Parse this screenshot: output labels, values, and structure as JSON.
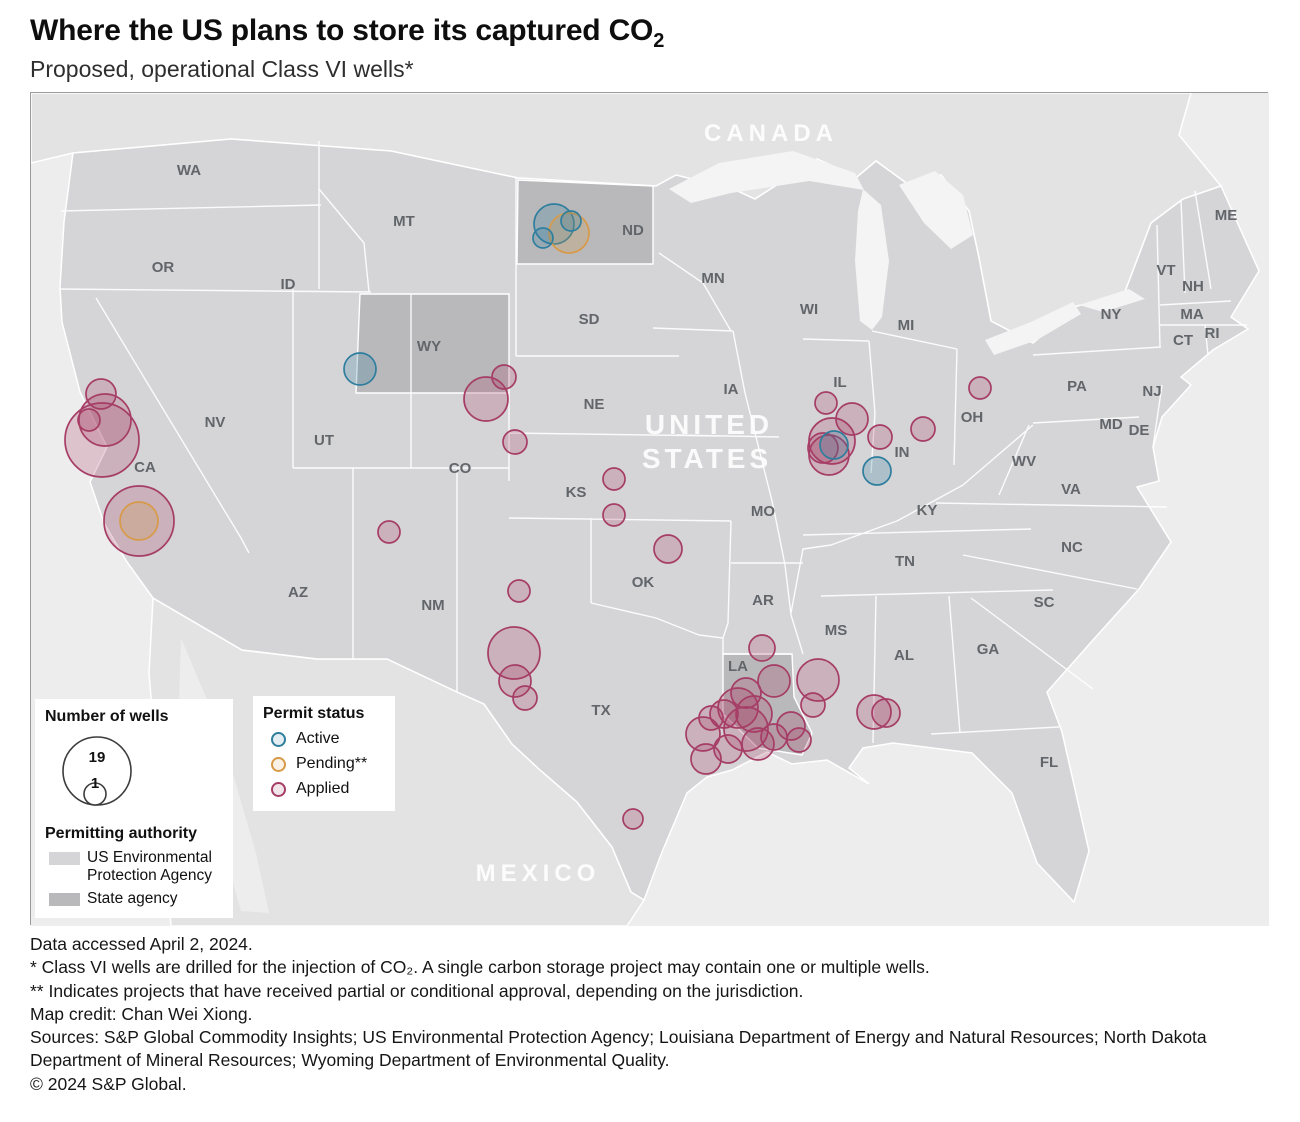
{
  "header": {
    "title_main": "Where the US plans to store its captured CO",
    "title_sub": "2",
    "subtitle": "Proposed, operational Class VI wells*"
  },
  "map": {
    "region_labels": [
      {
        "text": "CANADA",
        "x": 740,
        "y": 48,
        "size": 24,
        "spacing": 5
      },
      {
        "text": "UNITED",
        "x": 678,
        "y": 341,
        "size": 28,
        "spacing": 4
      },
      {
        "text": "STATES",
        "x": 676,
        "y": 375,
        "size": 28,
        "spacing": 4
      },
      {
        "text": "MEXICO",
        "x": 507,
        "y": 788,
        "size": 24,
        "spacing": 5
      }
    ],
    "state_labels": [
      {
        "t": "WA",
        "x": 158,
        "y": 76
      },
      {
        "t": "OR",
        "x": 132,
        "y": 173
      },
      {
        "t": "CA",
        "x": 114,
        "y": 373
      },
      {
        "t": "NV",
        "x": 184,
        "y": 328
      },
      {
        "t": "ID",
        "x": 257,
        "y": 190
      },
      {
        "t": "MT",
        "x": 373,
        "y": 127
      },
      {
        "t": "WY",
        "x": 398,
        "y": 252
      },
      {
        "t": "UT",
        "x": 293,
        "y": 346
      },
      {
        "t": "AZ",
        "x": 267,
        "y": 498
      },
      {
        "t": "NM",
        "x": 402,
        "y": 511
      },
      {
        "t": "CO",
        "x": 429,
        "y": 374
      },
      {
        "t": "ND",
        "x": 602,
        "y": 136
      },
      {
        "t": "SD",
        "x": 558,
        "y": 225
      },
      {
        "t": "NE",
        "x": 563,
        "y": 310
      },
      {
        "t": "KS",
        "x": 545,
        "y": 398
      },
      {
        "t": "OK",
        "x": 612,
        "y": 488
      },
      {
        "t": "TX",
        "x": 570,
        "y": 616
      },
      {
        "t": "MN",
        "x": 682,
        "y": 184
      },
      {
        "t": "IA",
        "x": 700,
        "y": 295
      },
      {
        "t": "MO",
        "x": 732,
        "y": 417
      },
      {
        "t": "AR",
        "x": 732,
        "y": 506
      },
      {
        "t": "LA",
        "x": 707,
        "y": 572
      },
      {
        "t": "WI",
        "x": 778,
        "y": 215
      },
      {
        "t": "IL",
        "x": 809,
        "y": 288
      },
      {
        "t": "MI",
        "x": 875,
        "y": 231
      },
      {
        "t": "IN",
        "x": 871,
        "y": 358
      },
      {
        "t": "OH",
        "x": 941,
        "y": 323
      },
      {
        "t": "KY",
        "x": 896,
        "y": 416
      },
      {
        "t": "TN",
        "x": 874,
        "y": 467
      },
      {
        "t": "MS",
        "x": 805,
        "y": 536
      },
      {
        "t": "AL",
        "x": 873,
        "y": 561
      },
      {
        "t": "GA",
        "x": 957,
        "y": 555
      },
      {
        "t": "SC",
        "x": 1013,
        "y": 508
      },
      {
        "t": "NC",
        "x": 1041,
        "y": 453
      },
      {
        "t": "VA",
        "x": 1040,
        "y": 395
      },
      {
        "t": "WV",
        "x": 993,
        "y": 367
      },
      {
        "t": "FL",
        "x": 1018,
        "y": 668
      },
      {
        "t": "PA",
        "x": 1046,
        "y": 292
      },
      {
        "t": "NY",
        "x": 1080,
        "y": 220
      },
      {
        "t": "NJ",
        "x": 1121,
        "y": 297
      },
      {
        "t": "MD",
        "x": 1080,
        "y": 330
      },
      {
        "t": "DE",
        "x": 1108,
        "y": 336
      },
      {
        "t": "CT",
        "x": 1152,
        "y": 246
      },
      {
        "t": "RI",
        "x": 1181,
        "y": 239
      },
      {
        "t": "MA",
        "x": 1161,
        "y": 220
      },
      {
        "t": "VT",
        "x": 1135,
        "y": 176
      },
      {
        "t": "NH",
        "x": 1162,
        "y": 192
      },
      {
        "t": "ME",
        "x": 1195,
        "y": 121
      }
    ],
    "status_colors": {
      "active": "#2f7e9e",
      "pending": "#d79a48",
      "applied": "#a63d66"
    },
    "authority_colors": {
      "epa": "#d5d5d7",
      "state": "#b9b9bb"
    },
    "bubbles": [
      {
        "x": 523,
        "y": 131,
        "r": 20,
        "s": "active"
      },
      {
        "x": 538,
        "y": 140,
        "r": 20,
        "s": "pending"
      },
      {
        "x": 540,
        "y": 128,
        "r": 10,
        "s": "active"
      },
      {
        "x": 512,
        "y": 145,
        "r": 10,
        "s": "active"
      },
      {
        "x": 329,
        "y": 276,
        "r": 16,
        "s": "active"
      },
      {
        "x": 455,
        "y": 306,
        "r": 22,
        "s": "applied"
      },
      {
        "x": 473,
        "y": 284,
        "r": 12,
        "s": "applied"
      },
      {
        "x": 70,
        "y": 301,
        "r": 15,
        "s": "applied"
      },
      {
        "x": 74,
        "y": 327,
        "r": 26,
        "s": "applied"
      },
      {
        "x": 58,
        "y": 327,
        "r": 11,
        "s": "applied"
      },
      {
        "x": 71,
        "y": 347,
        "r": 37,
        "s": "applied"
      },
      {
        "x": 108,
        "y": 428,
        "r": 35,
        "s": "applied"
      },
      {
        "x": 108,
        "y": 428,
        "r": 19,
        "s": "pending"
      },
      {
        "x": 484,
        "y": 349,
        "r": 12,
        "s": "applied"
      },
      {
        "x": 583,
        "y": 386,
        "r": 11,
        "s": "applied"
      },
      {
        "x": 583,
        "y": 422,
        "r": 11,
        "s": "applied"
      },
      {
        "x": 637,
        "y": 456,
        "r": 14,
        "s": "applied"
      },
      {
        "x": 358,
        "y": 439,
        "r": 11,
        "s": "applied"
      },
      {
        "x": 488,
        "y": 498,
        "r": 11,
        "s": "applied"
      },
      {
        "x": 483,
        "y": 560,
        "r": 26,
        "s": "applied"
      },
      {
        "x": 484,
        "y": 588,
        "r": 16,
        "s": "applied"
      },
      {
        "x": 494,
        "y": 605,
        "r": 12,
        "s": "applied"
      },
      {
        "x": 602,
        "y": 726,
        "r": 10,
        "s": "applied"
      },
      {
        "x": 795,
        "y": 310,
        "r": 11,
        "s": "applied"
      },
      {
        "x": 821,
        "y": 326,
        "r": 16,
        "s": "applied"
      },
      {
        "x": 801,
        "y": 348,
        "r": 23,
        "s": "applied"
      },
      {
        "x": 798,
        "y": 362,
        "r": 20,
        "s": "applied"
      },
      {
        "x": 792,
        "y": 355,
        "r": 15,
        "s": "applied"
      },
      {
        "x": 803,
        "y": 352,
        "r": 14,
        "s": "active"
      },
      {
        "x": 849,
        "y": 344,
        "r": 12,
        "s": "applied"
      },
      {
        "x": 846,
        "y": 378,
        "r": 14,
        "s": "active"
      },
      {
        "x": 892,
        "y": 336,
        "r": 12,
        "s": "applied"
      },
      {
        "x": 949,
        "y": 295,
        "r": 11,
        "s": "applied"
      },
      {
        "x": 731,
        "y": 555,
        "r": 13,
        "s": "applied"
      },
      {
        "x": 743,
        "y": 588,
        "r": 16,
        "s": "applied"
      },
      {
        "x": 787,
        "y": 587,
        "r": 21,
        "s": "applied"
      },
      {
        "x": 782,
        "y": 612,
        "r": 12,
        "s": "applied"
      },
      {
        "x": 715,
        "y": 600,
        "r": 15,
        "s": "applied"
      },
      {
        "x": 707,
        "y": 615,
        "r": 20,
        "s": "applied"
      },
      {
        "x": 723,
        "y": 621,
        "r": 18,
        "s": "applied"
      },
      {
        "x": 715,
        "y": 636,
        "r": 22,
        "s": "applied"
      },
      {
        "x": 693,
        "y": 621,
        "r": 14,
        "s": "applied"
      },
      {
        "x": 680,
        "y": 625,
        "r": 12,
        "s": "applied"
      },
      {
        "x": 672,
        "y": 641,
        "r": 17,
        "s": "applied"
      },
      {
        "x": 675,
        "y": 666,
        "r": 15,
        "s": "applied"
      },
      {
        "x": 697,
        "y": 656,
        "r": 14,
        "s": "applied"
      },
      {
        "x": 727,
        "y": 651,
        "r": 16,
        "s": "applied"
      },
      {
        "x": 743,
        "y": 644,
        "r": 13,
        "s": "applied"
      },
      {
        "x": 760,
        "y": 633,
        "r": 14,
        "s": "applied"
      },
      {
        "x": 768,
        "y": 647,
        "r": 12,
        "s": "applied"
      },
      {
        "x": 843,
        "y": 619,
        "r": 17,
        "s": "applied"
      },
      {
        "x": 855,
        "y": 620,
        "r": 14,
        "s": "applied"
      }
    ]
  },
  "legend": {
    "wells": {
      "title": "Number of wells",
      "max_label": "19",
      "min_label": "1"
    },
    "status": {
      "title": "Permit status",
      "items": [
        {
          "label": "Active",
          "key": "active"
        },
        {
          "label": "Pending**",
          "key": "pending"
        },
        {
          "label": "Applied",
          "key": "applied"
        }
      ]
    },
    "authority": {
      "title": "Permitting authority",
      "items": [
        {
          "label": "US Environmental Protection Agency",
          "key": "epa"
        },
        {
          "label": "State agency",
          "key": "state"
        }
      ]
    }
  },
  "footer": {
    "lines": [
      "Data accessed April 2, 2024.",
      "* Class VI wells are drilled for the injection of CO₂. A single carbon storage project may contain one or multiple wells.",
      "** Indicates projects that have received partial or conditional approval, depending on the jurisdiction.",
      "Map credit: Chan Wei Xiong.",
      "Sources: S&P Global Commodity Insights; US Environmental Protection Agency; Louisiana Department of Energy and Natural Resources; North Dakota Department of Mineral Resources; Wyoming Department of Environmental Quality.",
      "© 2024 S&P Global."
    ]
  }
}
